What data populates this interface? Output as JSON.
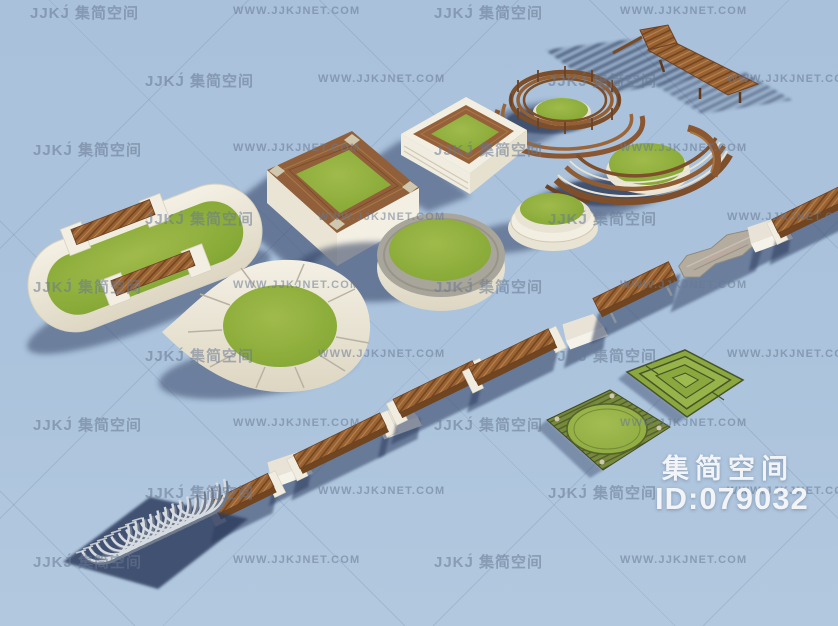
{
  "watermarks": {
    "texts": {
      "brand": "JJKJ́ 集简空间",
      "site": "WWW.JJKJNET.COM"
    },
    "rows": [
      {
        "y": 2,
        "items": [
          {
            "x": 30,
            "k": "brand"
          },
          {
            "x": 233,
            "k": "site"
          },
          {
            "x": 434,
            "k": "brand"
          },
          {
            "x": 620,
            "k": "site"
          }
        ]
      },
      {
        "y": 70,
        "items": [
          {
            "x": 145,
            "k": "brand"
          },
          {
            "x": 318,
            "k": "site"
          },
          {
            "x": 548,
            "k": "brand"
          },
          {
            "x": 727,
            "k": "site"
          }
        ]
      },
      {
        "y": 139,
        "items": [
          {
            "x": 33,
            "k": "brand"
          },
          {
            "x": 233,
            "k": "site"
          },
          {
            "x": 434,
            "k": "brand"
          },
          {
            "x": 620,
            "k": "site"
          }
        ]
      },
      {
        "y": 208,
        "items": [
          {
            "x": 145,
            "k": "brand"
          },
          {
            "x": 318,
            "k": "site"
          },
          {
            "x": 548,
            "k": "brand"
          },
          {
            "x": 727,
            "k": "site"
          }
        ]
      },
      {
        "y": 276,
        "items": [
          {
            "x": 33,
            "k": "brand"
          },
          {
            "x": 233,
            "k": "site"
          },
          {
            "x": 434,
            "k": "brand"
          },
          {
            "x": 620,
            "k": "site"
          }
        ]
      },
      {
        "y": 345,
        "items": [
          {
            "x": 145,
            "k": "brand"
          },
          {
            "x": 318,
            "k": "site"
          },
          {
            "x": 548,
            "k": "brand"
          },
          {
            "x": 727,
            "k": "site"
          }
        ]
      },
      {
        "y": 414,
        "items": [
          {
            "x": 33,
            "k": "brand"
          },
          {
            "x": 233,
            "k": "site"
          },
          {
            "x": 434,
            "k": "brand"
          },
          {
            "x": 620,
            "k": "site"
          }
        ]
      },
      {
        "y": 482,
        "items": [
          {
            "x": 145,
            "k": "brand"
          },
          {
            "x": 318,
            "k": "site"
          },
          {
            "x": 548,
            "k": "brand"
          },
          {
            "x": 727,
            "k": "site"
          }
        ]
      },
      {
        "y": 551,
        "items": [
          {
            "x": 33,
            "k": "brand"
          },
          {
            "x": 233,
            "k": "site"
          },
          {
            "x": 434,
            "k": "brand"
          },
          {
            "x": 620,
            "k": "site"
          }
        ]
      }
    ]
  },
  "overlay": {
    "title": "集简空间",
    "id_label": "ID:079032"
  },
  "colors": {
    "background": "#abc3dc",
    "grass": "#8fb23c",
    "wood": "#9a6233",
    "cream": "#f2eee2",
    "stone": "#a8a59b",
    "metal": "#d3d8de",
    "shadow": "#2f3e61",
    "overlay_text": "#f2f4f7",
    "watermark_text": "#68789 2"
  },
  "scene": {
    "description_objects": [
      "square-wood-rim-planter",
      "square-frame-planter",
      "spiral-wood-pergola-bench",
      "wood-lounge-chair",
      "boat-shape-wood-planter",
      "stadium-planter-with-benches",
      "teardrop-planter",
      "round-stone-planter",
      "round-tiered-planter",
      "bench-chain",
      "curved-metal-bench",
      "stone-log-seat",
      "striped-circle-parterre",
      "geometric-parterre"
    ]
  }
}
